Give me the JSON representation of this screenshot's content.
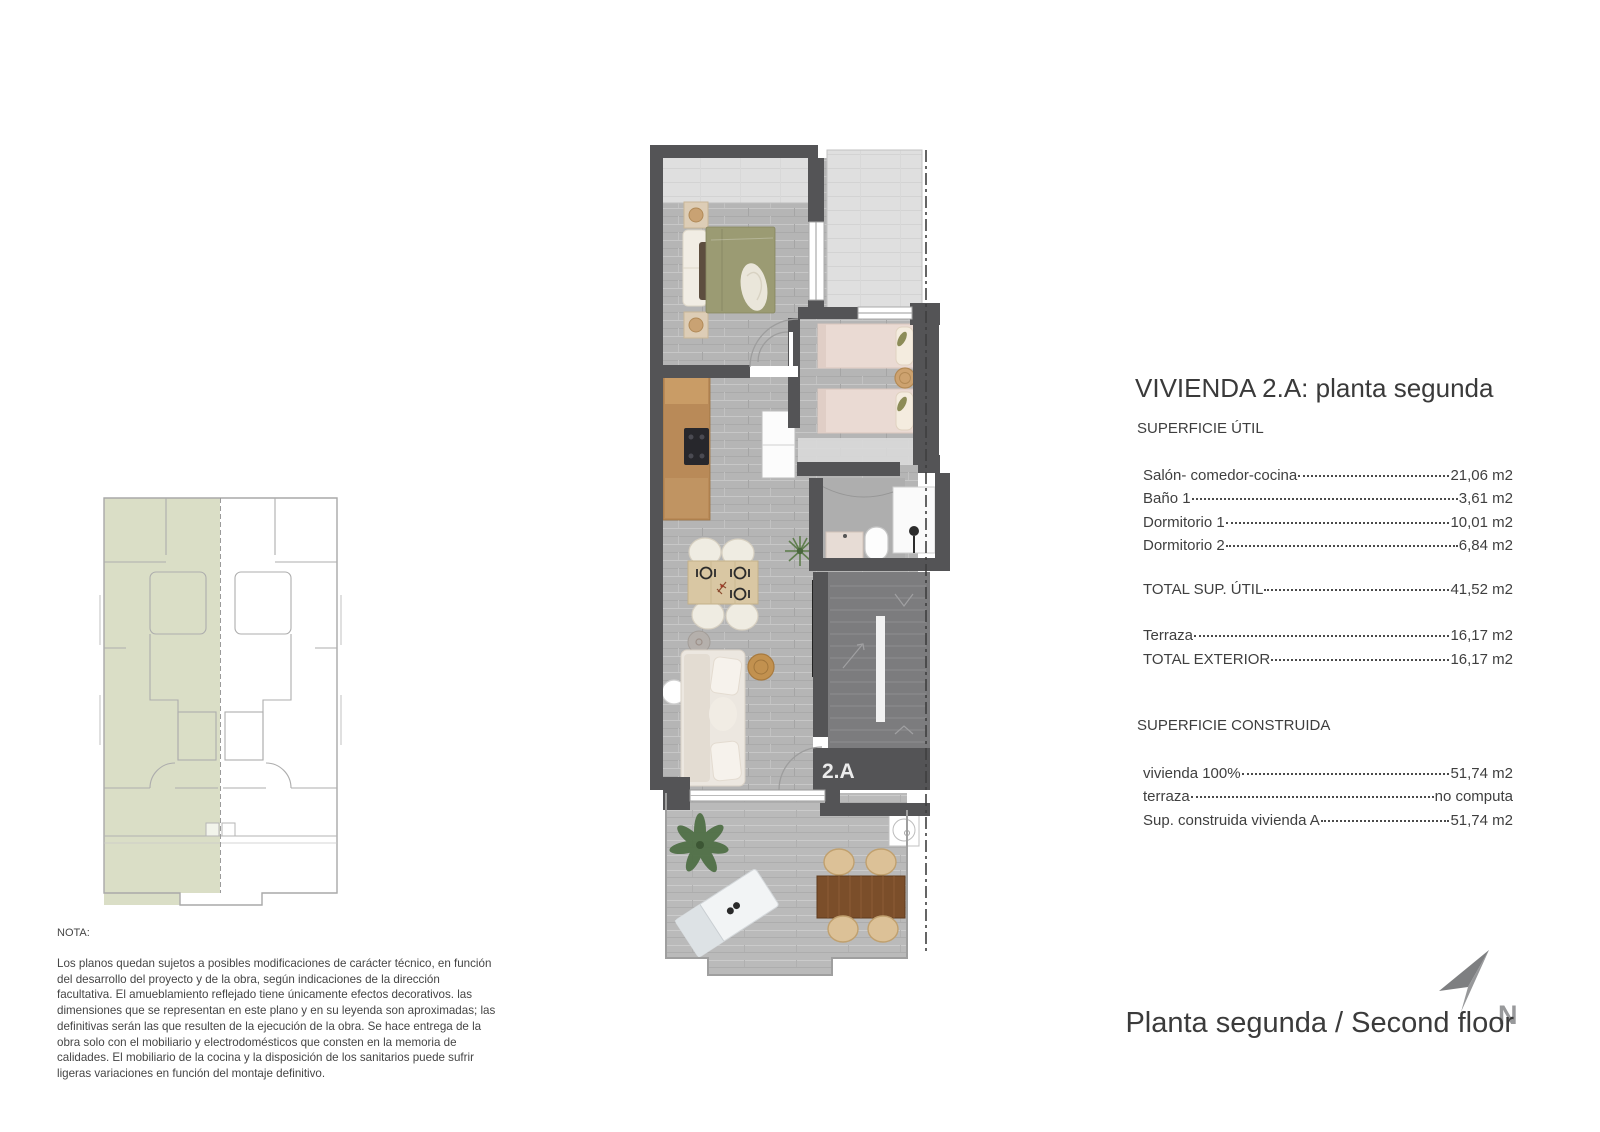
{
  "plan": {
    "unit_label": "2.A"
  },
  "panel": {
    "title": "VIVIENDA 2.A: planta segunda",
    "util": {
      "heading": "SUPERFICIE ÚTIL",
      "rows": [
        {
          "label": "Salón- comedor-cocina",
          "value": "21,06 m2"
        },
        {
          "label": "Baño 1",
          "value": "3,61 m2"
        },
        {
          "label": "Dormitorio 1",
          "value": "10,01 m2"
        },
        {
          "label": "Dormitorio 2",
          "value": "6,84 m2"
        }
      ],
      "total": {
        "label": "TOTAL SUP. ÚTIL",
        "value": "41,52 m2"
      }
    },
    "exterior": {
      "rows": [
        {
          "label": "Terraza",
          "value": "16,17 m2"
        },
        {
          "label": "TOTAL EXTERIOR",
          "value": "16,17 m2"
        }
      ]
    },
    "construida": {
      "heading": "SUPERFICIE CONSTRUIDA",
      "rows": [
        {
          "label": "vivienda 100%",
          "value": "51,74 m2"
        },
        {
          "label": "terraza",
          "value": "no computa"
        },
        {
          "label": "Sup. construida vivienda A",
          "value": "51,74 m2"
        }
      ]
    }
  },
  "note": {
    "heading": "NOTA:",
    "body": "Los planos quedan sujetos a posibles modificaciones de carácter técnico, en función del desarrollo del proyecto y de la obra, según indicaciones de la dirección facultativa. El amueblamiento reflejado tiene únicamente efectos decorativos. las dimensiones que se representan en este plano y en su leyenda son aproximadas; las definitivas serán las que resulten de la ejecución de la obra. Se hace entrega de la obra solo con el mobiliario y electrodomésticos que consten en la memoria de calidades. El mobiliario de la cocina y la disposición de los sanitarios puede sufrir ligeras variaciones en función del montaje definitivo."
  },
  "footer": {
    "caption": "Planta segunda / Second floor",
    "north_label": "N"
  },
  "colors": {
    "wall": "#545456",
    "interior_floor": "#b5b5b5",
    "roof_area": "#dfdfdf",
    "stairs": "#7c7c7e",
    "terrace_floor": "#bababa",
    "highlight_green": "#dadec6",
    "text": "#3e3e3e",
    "wood": "#b98a58",
    "bed_olive": "#9b9b73",
    "bed_pink": "#eadad3",
    "outdoor_table_brown": "#7b4e2a"
  }
}
